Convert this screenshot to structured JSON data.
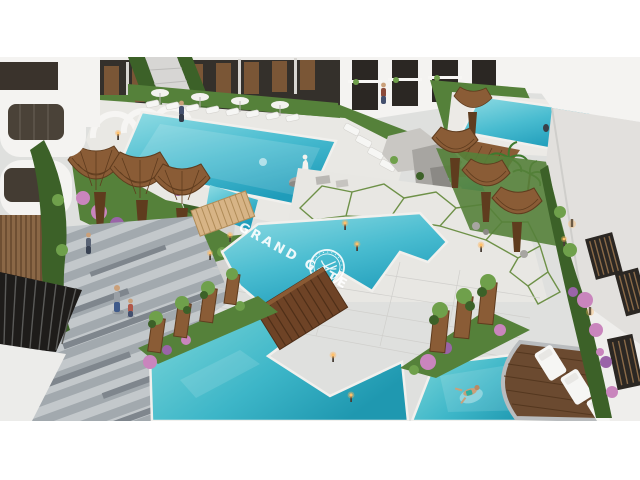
{
  "meta": {
    "type": "3d-architectural-render",
    "subject": "Aerial daytime render of the Grand Gate residential resort courtyard with swimming pools"
  },
  "scene": {
    "pool_label": "GRAND GATE",
    "logo": "grand-gate-circular-emblem",
    "elements": [
      "apartment-buildings",
      "main-pool",
      "courtyard-pool",
      "grand-gate-pool",
      "lower-lagoon-pool",
      "lap-pool",
      "upper-wood-bridge",
      "lower-wood-bridge",
      "supertree-canopies",
      "wood-planter-towers",
      "sun-loungers",
      "pool-umbrellas",
      "curved-wood-deck",
      "swimmer",
      "pedestrians",
      "statue",
      "rock-waterfall",
      "flower-balls",
      "palm-trees",
      "striped-plaza",
      "crazy-paving",
      "garden-lights"
    ]
  },
  "palette": {
    "water-1": "#93dde4",
    "water-2": "#49bcd0",
    "water-3": "#1f9cba",
    "paving": "#dfe0de",
    "plaza": "#e8e7e3",
    "stripe-a": "#c3c8cb",
    "stripe-b": "#a2a9ae",
    "stripe-c": "#7f868d",
    "grass": "#55813a",
    "grass-d": "#3c6128",
    "leaf": "#6fa04b",
    "wood": "#8a5c36",
    "wood-d": "#5f3c1e",
    "deck": "#6b4a30",
    "bridge-light": "#d7b486",
    "bridge-dark": "#6e4326",
    "bldg": "#f4f3f1",
    "bldg-sh": "#e2e0dd",
    "facade-dark": "#34302b",
    "window": "#2b2723",
    "door": "#7a5636",
    "flower-pink": "#c985bd",
    "flower-violet": "#9a64a8",
    "lounger": "#f6f6f4",
    "stone": "#a7a5a1",
    "light-warm": "#ffc069",
    "grout-green": "#6e9148"
  }
}
